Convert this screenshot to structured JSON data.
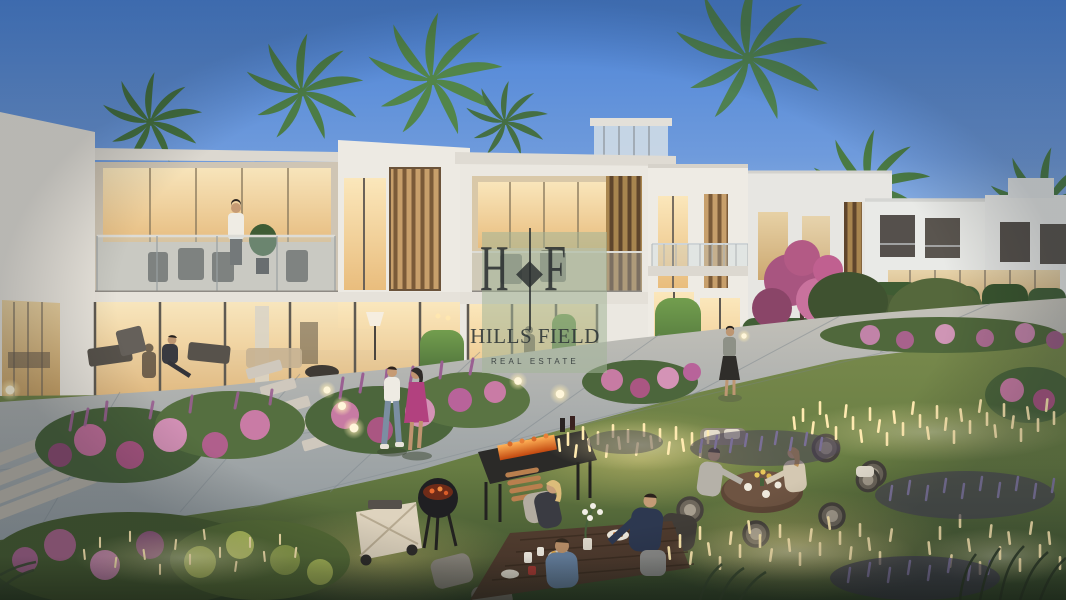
{
  "watermark": {
    "monogram_left": "H",
    "monogram_right": "F",
    "brand_name": "HILLS FIELD",
    "tagline": "REAL ESTATE",
    "panel_color": "rgba(163,181,152,0.55)",
    "text_color": "#32393a"
  },
  "scene": {
    "type": "architectural-render",
    "time_of_day": "dusk",
    "elements": [
      "townhouse-row",
      "palm-trees",
      "garden-path",
      "flower-beds",
      "glowing-reed-lights",
      "globe-lamps",
      "outdoor-dining-tables",
      "bbq-area",
      "people-walking",
      "balcony-terrace"
    ]
  },
  "palette": {
    "sky_top": "#4a82d6",
    "sky_horizon": "#ccdcee",
    "facade_white": "#ebe8e1",
    "window_glow": "#f7e0ab",
    "wood_slat": "#c79f6b",
    "hedge_green": "#4e7340",
    "grass_light": "#87944f",
    "grass_dark": "#33462a",
    "pavement_warm": "#c6c3ba",
    "pavement_cool": "#8e979c",
    "flower_pink": "#c8699a",
    "lavender": "#7a6f96",
    "reed_glow": "#ffeab0"
  }
}
